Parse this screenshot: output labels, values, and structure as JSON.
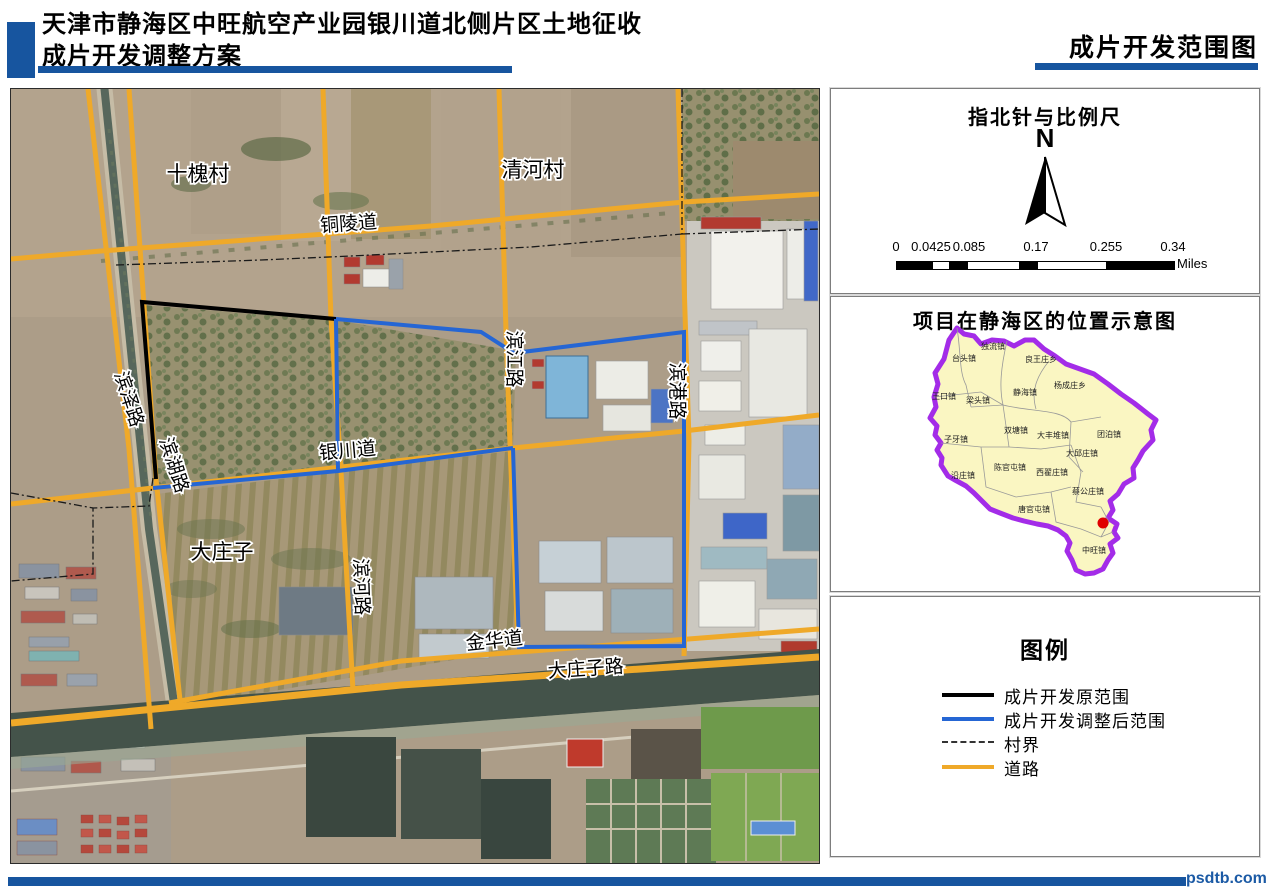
{
  "header": {
    "title_line1": "天津市静海区中旺航空产业园银川道北侧片区土地征收",
    "title_line2": "成片开发调整方案",
    "right_title": "成片开发范围图",
    "accent_color": "#17559F"
  },
  "map": {
    "labels": [
      {
        "text": "十槐村"
      },
      {
        "text": "清河村"
      },
      {
        "text": "铜陵道"
      },
      {
        "text": "滨江路"
      },
      {
        "text": "滨港路"
      },
      {
        "text": "滨泽路"
      },
      {
        "text": "滨湖路"
      },
      {
        "text": "银川道"
      },
      {
        "text": "大庄子"
      },
      {
        "text": "滨河路"
      },
      {
        "text": "金华道"
      },
      {
        "text": "大庄子路"
      }
    ],
    "scope_original_color": "#000000",
    "scope_adjusted_color": "#2566D4",
    "road_color": "#EFA929"
  },
  "compass_panel": {
    "title": "指北针与比例尺",
    "north_label": "N",
    "scale_ticks": [
      "0",
      "0.0425",
      "0.085",
      "0.17",
      "0.255",
      "0.34"
    ],
    "unit_label": "Miles"
  },
  "location_panel": {
    "title": "项目在静海区的位置示意图",
    "towns": [
      "独流镇",
      "台头镇",
      "良王庄乡",
      "杨成庄乡",
      "王口镇",
      "梁头镇",
      "静海镇",
      "双塘镇",
      "大丰堆镇",
      "团泊镇",
      "子牙镇",
      "大邱庄镇",
      "陈官屯镇",
      "西翟庄镇",
      "沿庄镇",
      "蔡公庄镇",
      "唐官屯镇",
      "中旺镇"
    ],
    "district_fill": "#FAF6C2",
    "district_border": "#A32CE8",
    "marker_color": "#E00000"
  },
  "legend_panel": {
    "title": "图例",
    "items": [
      {
        "label": "成片开发原范围",
        "color": "#000000",
        "style": "solid"
      },
      {
        "label": "成片开发调整后范围",
        "color": "#2566D4",
        "style": "solid"
      },
      {
        "label": "村界",
        "color": "#333333",
        "style": "dash-dot"
      },
      {
        "label": "道路",
        "color": "#EFA929",
        "style": "solid"
      }
    ]
  },
  "footer": {
    "watermark": "psdtb.com"
  }
}
